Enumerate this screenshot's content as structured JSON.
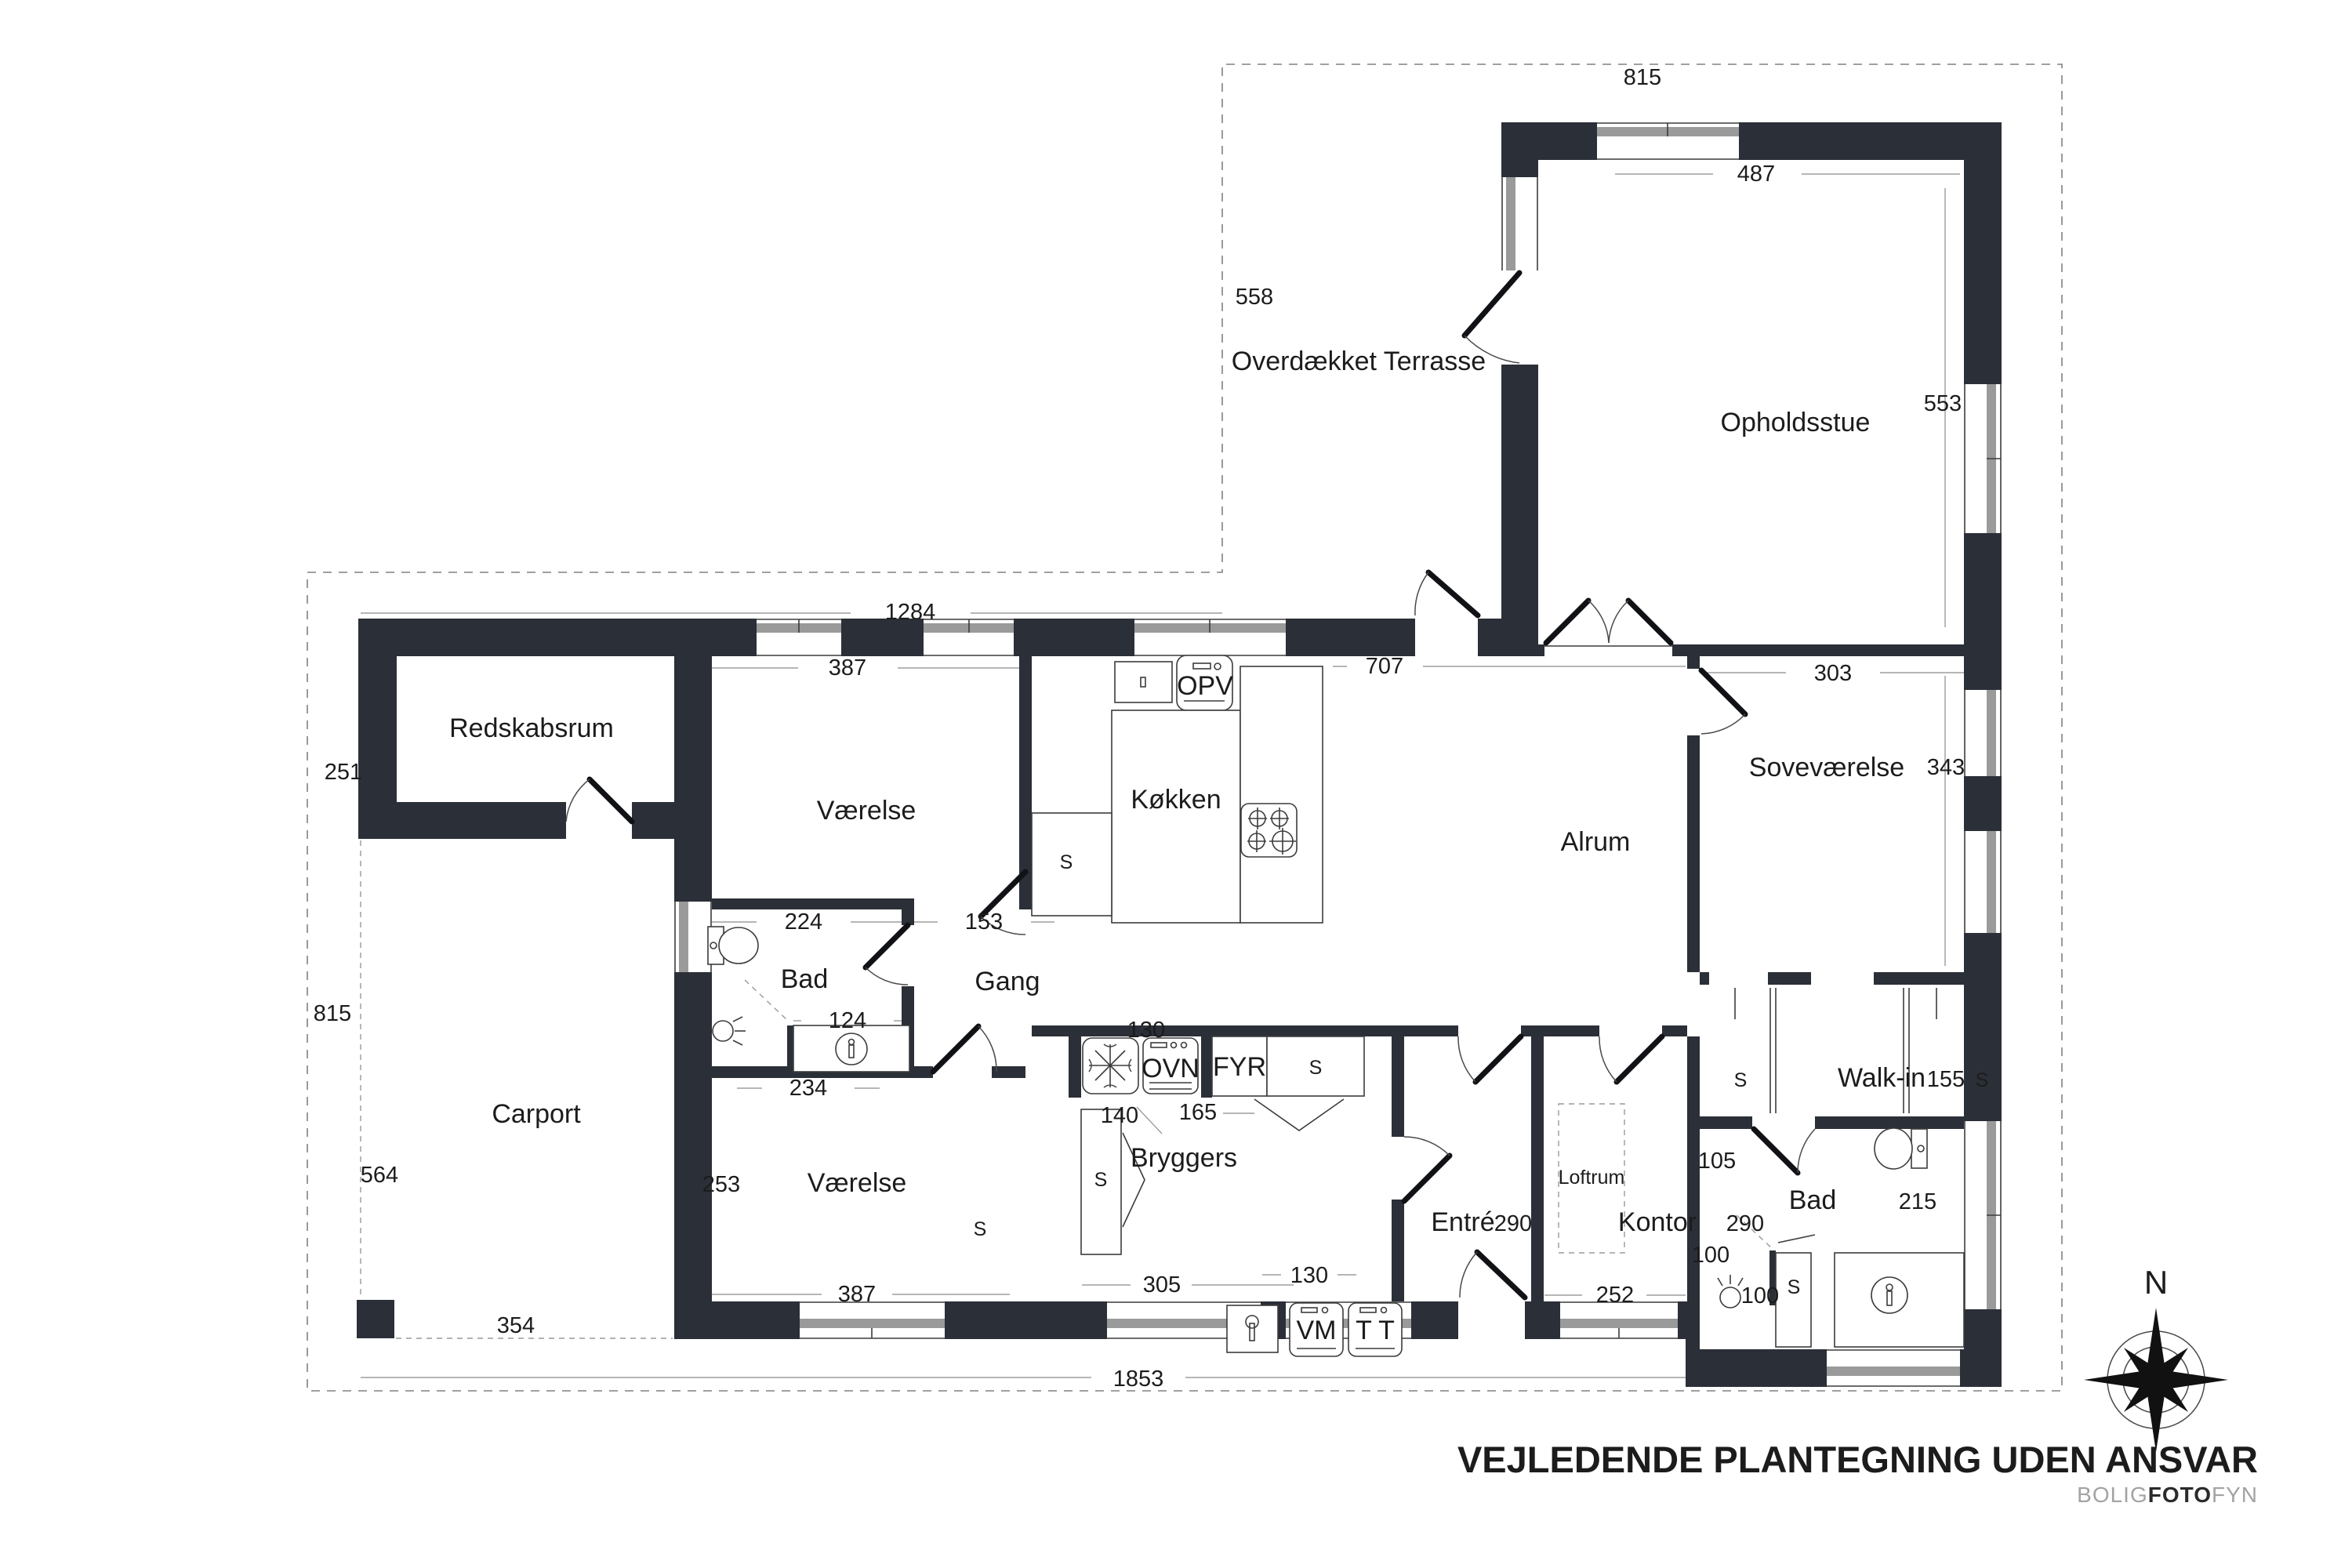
{
  "labels": {
    "rooms": [
      "Overdækket Terrasse",
      "Opholdsstue",
      "Redskabsrum",
      "Værelse",
      "Køkken",
      "Alrum",
      "Soveværelse",
      "Bad",
      "Gang",
      "Carport",
      "Værelse",
      "Bryggers",
      "Entré",
      "Kontor",
      "Walk-in",
      "Bad",
      "Loftrum"
    ],
    "dims": [
      "815",
      "558",
      "487",
      "553",
      "1284",
      "251",
      "387",
      "707",
      "303",
      "343",
      "815",
      "564",
      "224",
      "153",
      "124",
      "234",
      "130",
      "140",
      "165",
      "290",
      "290",
      "105",
      "155",
      "215",
      "100",
      "100",
      "253",
      "387",
      "305",
      "130",
      "252",
      "354",
      "1853"
    ],
    "fixtures": [
      "OPV",
      "OVN",
      "FYR",
      "S",
      "S",
      "S",
      "S",
      "S",
      "S",
      "S",
      "VM",
      "T T",
      "N"
    ]
  },
  "title": "VEJLEDENDE PLANTEGNING UDEN ANSVAR",
  "brand": {
    "gray1": "BOLIG",
    "dark": "FOTO",
    "gray2": "FYN"
  },
  "colors": {
    "wall": "#2b2f37",
    "line": "#3c3c3c",
    "windowband": "#9a9a9a",
    "dashed": "#808080"
  }
}
